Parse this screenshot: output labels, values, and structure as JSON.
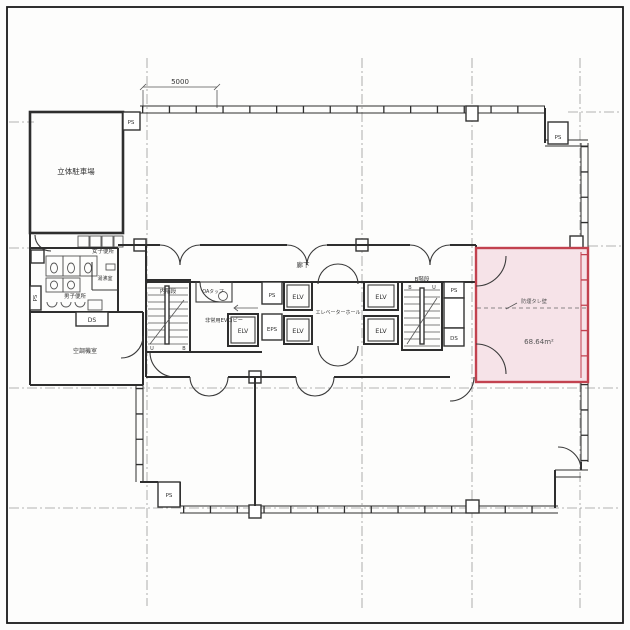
{
  "drawing": {
    "type": "architectural-floor-plan",
    "dimension_top": "5000",
    "labels": {
      "parking": "立体駐車場",
      "women_toilet": "女子便所",
      "kitchenette": "湯沸室",
      "men_toilet": "男子便所",
      "hvac_room": "空調機室",
      "corridor": "廊下",
      "stair_inner": "内階段",
      "emergency_ev_lobby": "非常用EVロビー",
      "oa_tap": "OAタップ",
      "elv": "ELV",
      "elevator_hall": "エレベーターホール",
      "stair_b": "B階段",
      "ps": "PS",
      "eps": "EPS",
      "ds": "DS",
      "mark_u": "U",
      "mark_b": "B"
    },
    "highlight_room": {
      "smoke_wall_note": "防煙タレ壁",
      "area": "68.64m²",
      "fill_color": "#f6e3e8",
      "border_color": "#c2424f"
    },
    "colors": {
      "wall": "#2e2e2e",
      "grid": "#999999",
      "background": "#fdfdfc"
    }
  }
}
